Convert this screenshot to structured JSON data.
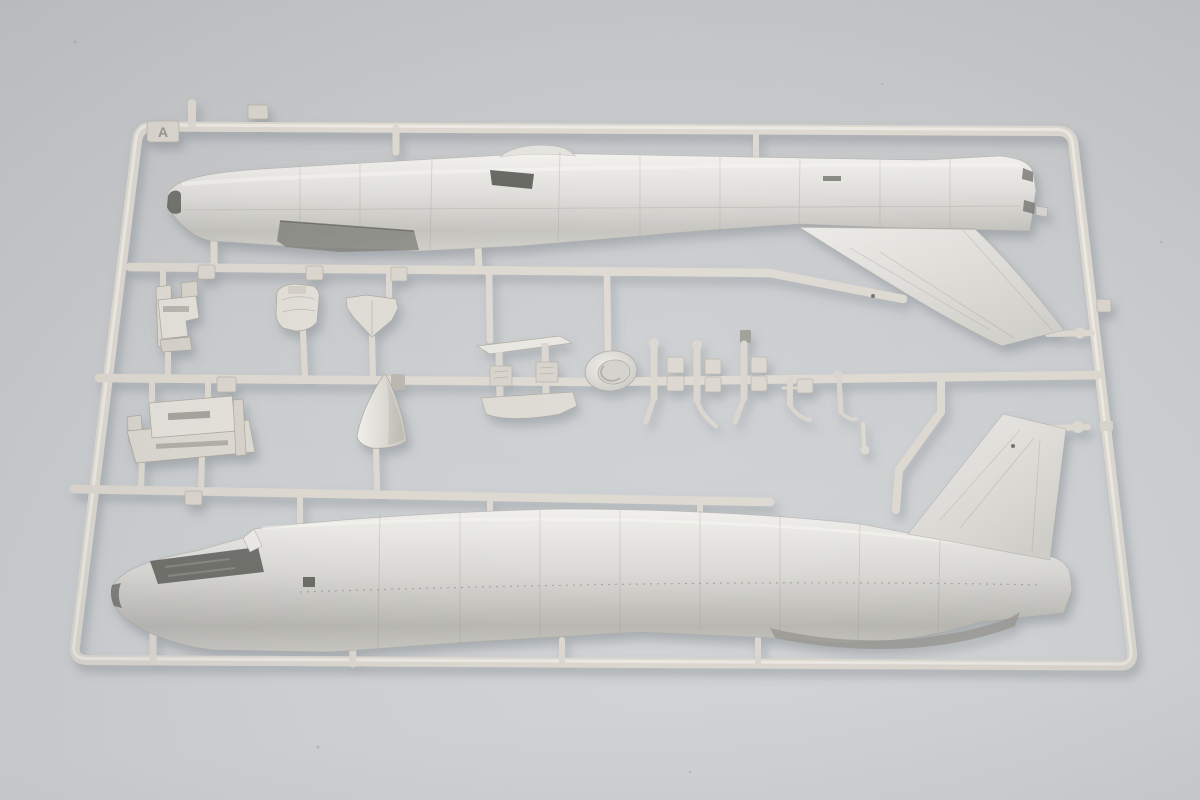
{
  "photo": {
    "description": "Photograph of an injection-moulded plastic model kit sprue with two jet-aircraft fuselage halves and small detail parts on a grey backdrop",
    "background_color": "#c8cacc",
    "plastic_color": "#dcd8d0"
  },
  "sprue": {
    "letter_tag": "A",
    "part_labels": {
      "frame": "Sprue runner frame",
      "fuselage_upper": "Fuselage half (upper)",
      "fuselage_lower": "Fuselage half (lower)",
      "tail_fin_upper": "Tail fin on upper fuselage half",
      "tail_fin_lower": "Tail fin on lower fuselage half",
      "ejection_seat": "Ejection seat",
      "cockpit_bulkhead": "Cockpit bulkhead",
      "intake_splitter": "Intake splitter plate",
      "shock_cone": "Intake shock cone",
      "cockpit_tub": "Cockpit tub / gear bay",
      "gear_doors": "Landing gear door set",
      "wheel_dish": "Wheel hub / dish",
      "gear_struts": "Landing gear struts and links",
      "number_tabs": "Embossed part-number tabs (illegible)"
    }
  }
}
